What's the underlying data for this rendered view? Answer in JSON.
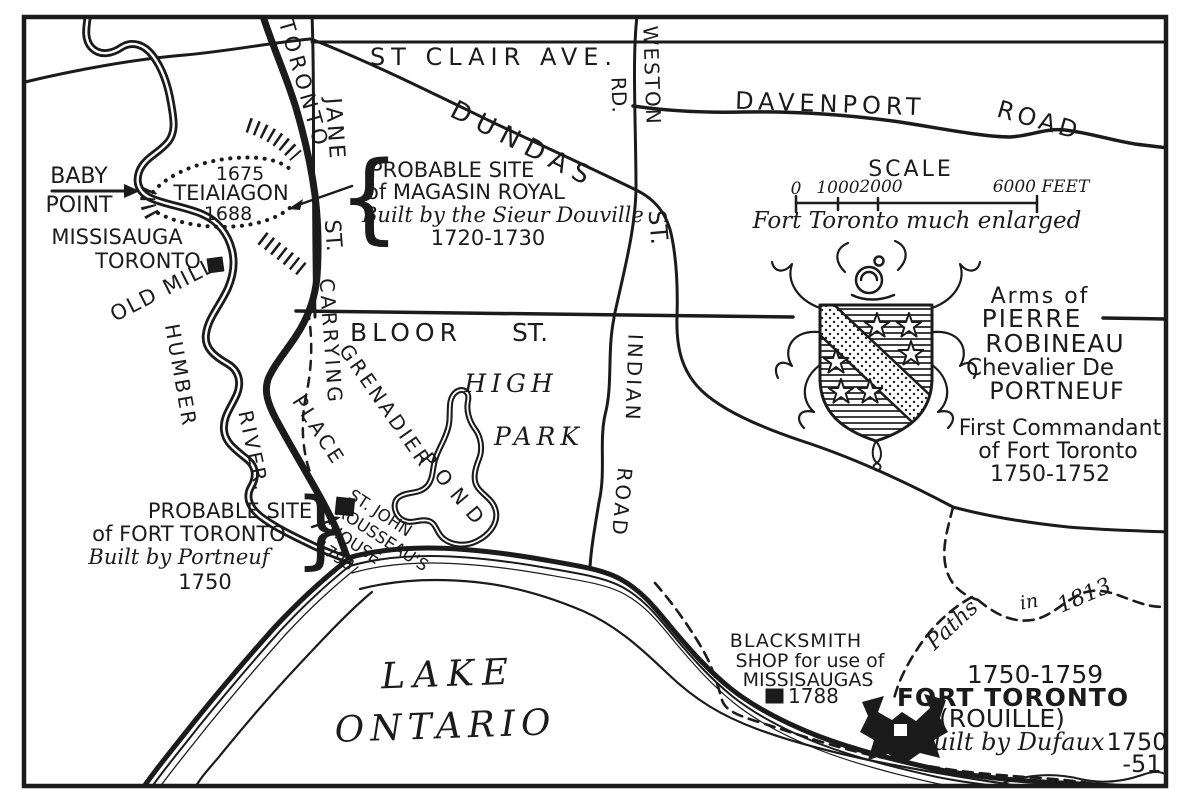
{
  "map": {
    "background": "#ffffff",
    "ink": "#1b1b1b",
    "streets": {
      "st_clair": "ST CLAIR AVE.",
      "davenport": "DAVENPORT",
      "davenport_road": "ROAD",
      "weston": "WESTON",
      "weston_rd": "RD.",
      "dundas": "DUNDAS",
      "dundas_st": "ST.",
      "jane": "JANE",
      "jane_st": "ST.",
      "bloor": "BLOOR",
      "bloor_st": "ST.",
      "indian": "INDIAN",
      "indian_road": "ROAD",
      "trail_toronto": "TORONTO",
      "trail_carrying": "CARRYING",
      "trail_place": "PLACE"
    },
    "water": {
      "humber": "HUMBER",
      "river": "RIVER.",
      "lake": "LAKE",
      "ontario": "ONTARIO",
      "grenadier": "GRENADIER",
      "pond": "POND"
    },
    "park": {
      "high": "HIGH",
      "park": "PARK"
    },
    "sites": {
      "baby_point": [
        "BABY",
        "POINT"
      ],
      "missisauga": [
        "MISSISAUGA",
        "TORONTO"
      ],
      "teiaiagon": [
        "1675",
        "TEIAIAGON",
        "1688"
      ],
      "old_mill": "OLD MILL",
      "magasin_royal": [
        "PROBABLE SITE",
        "of MAGASIN ROYAL",
        "Built by the Sieur Douville",
        "1720-1730"
      ],
      "fort_toronto_site": [
        "PROBABLE SITE",
        "of FORT TORONTO",
        "Built by Portneuf",
        "1750"
      ],
      "rousseau_house": [
        "ST. JOHN",
        "ROUSSEAU'S",
        "HOUSE",
        "1793"
      ],
      "blacksmith": [
        "BLACKSMITH",
        "SHOP for use of",
        "MISSISAUGAS",
        "1788"
      ],
      "fort_rouille": [
        "1750-1759",
        "FORT TORONTO",
        "(ROUILLE)",
        "Built by Dufaux",
        "1750",
        "-51"
      ],
      "paths_1813": [
        "Paths",
        "in",
        "1813"
      ]
    },
    "arms": {
      "lines": [
        "Arms of",
        "PIERRE",
        "ROBINEAU",
        "Chevalier De",
        "PORTNEUF",
        "First Commandant",
        "of Fort Toronto",
        "1750-1752"
      ]
    },
    "scale": {
      "title": "SCALE",
      "tick_0": "0",
      "tick_1000": "1000",
      "tick_2000": "2000",
      "tick_6000": "6000 FEET",
      "note": "Fort Toronto much enlarged"
    },
    "glyphs": {
      "brace_open": "{",
      "brace_close": "}"
    }
  }
}
